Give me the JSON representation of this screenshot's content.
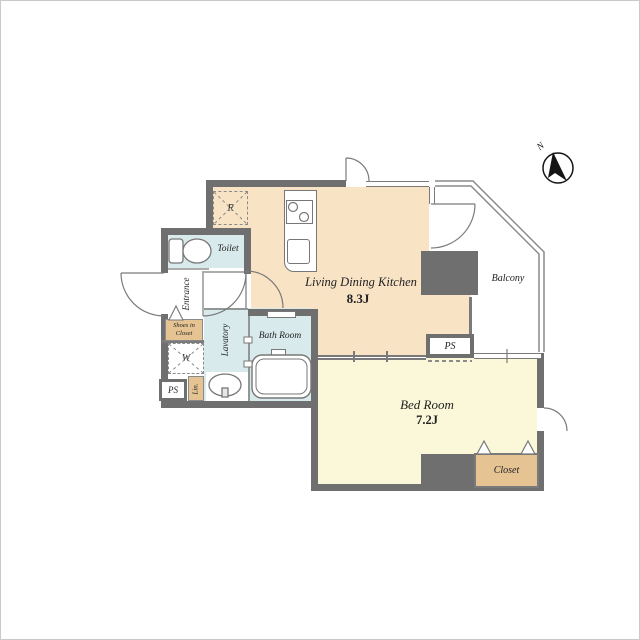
{
  "plan": {
    "title": "apartment floor plan",
    "rooms": {
      "ldk": {
        "name": "Living Dining Kitchen",
        "area": "8.3J"
      },
      "bedroom": {
        "name": "Bed Room",
        "area": "7.2J"
      },
      "balcony": {
        "label": "Balcony"
      },
      "bath": {
        "label": "Bath Room"
      },
      "toilet": {
        "label": "Toilet"
      },
      "entrance": {
        "label": "Entrance"
      },
      "lavatory": {
        "label": "Lavatory"
      },
      "closet": {
        "label": "Closet"
      },
      "shoes_closet": {
        "label_line1": "Shoes in",
        "label_line2": "Closet"
      },
      "linen": {
        "label": "Lin."
      },
      "ps_balcony": {
        "label": "PS"
      },
      "ps_left": {
        "label": "PS"
      },
      "washer": {
        "label": "W"
      },
      "refrigerator": {
        "label": "R"
      }
    },
    "compass": {
      "label": "N"
    },
    "colors": {
      "wall": "#6f6f6f",
      "ldk_floor": "#f8e3c5",
      "bedroom_floor": "#fbf8da",
      "wet_area_floor": "#d9eaec",
      "closet_fill": "#e5c393",
      "line": "#7a7a7a"
    }
  }
}
